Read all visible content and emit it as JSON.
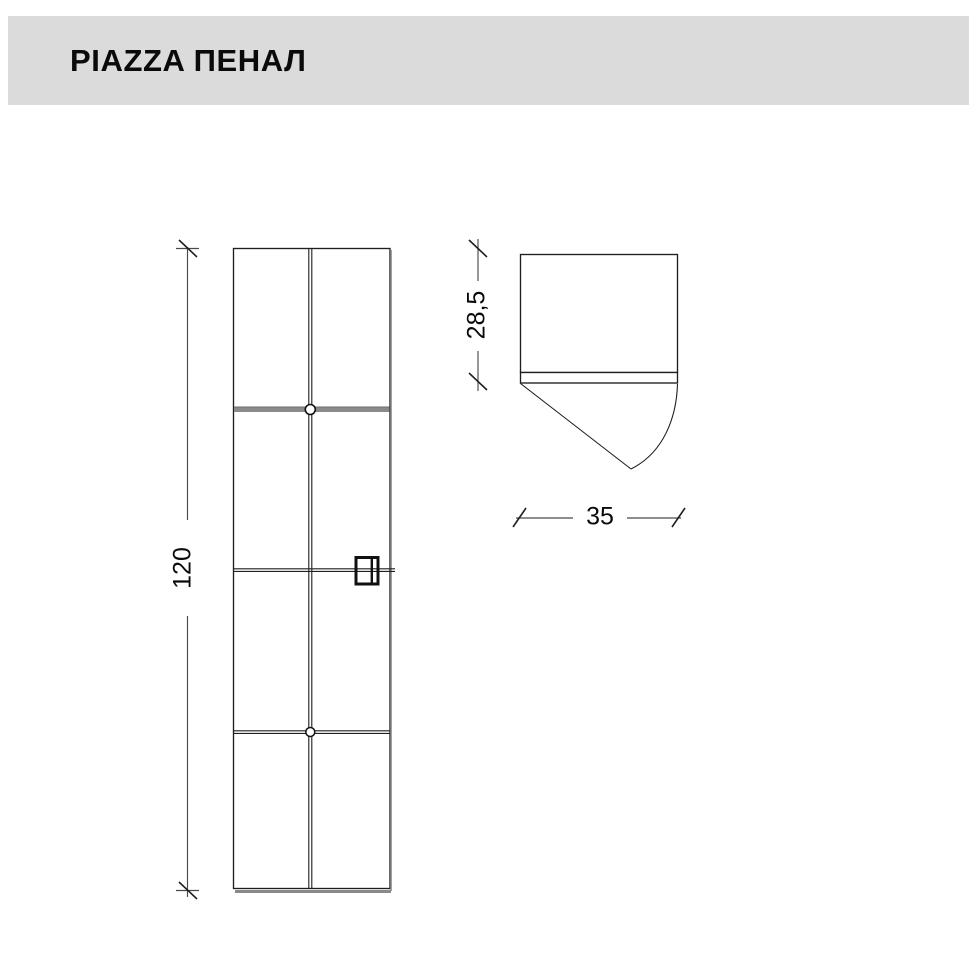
{
  "header": {
    "title": "PIAZZA ПЕНАЛ"
  },
  "colors": {
    "header-bg": "#dbdbdb",
    "page-bg": "#ffffff",
    "line": "#1f1f1f",
    "shadow": "#8a8a8a",
    "dim-line": "#4a4a4a",
    "text": "#0a0a0a"
  },
  "drawing": {
    "front_view": {
      "height_dimension": {
        "label": "120"
      }
    },
    "plan_view": {
      "depth_dimension": {
        "label": "28,5"
      },
      "width_dimension": {
        "label": "35"
      }
    }
  }
}
